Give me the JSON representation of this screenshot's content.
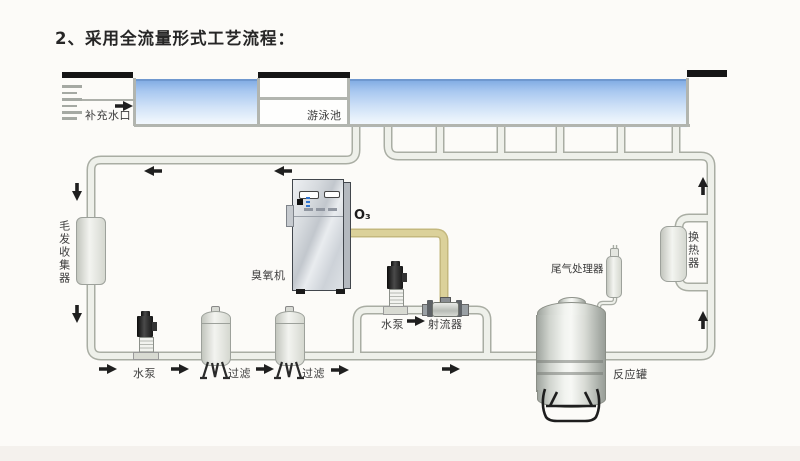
{
  "title": "2、采用全流量形式工艺流程：",
  "pool": {
    "makeup_inlet": "补充水口",
    "swimming_pool": "游泳池"
  },
  "equipment": {
    "hair_collector": "毛发收集器",
    "ozone_generator": "臭氧机",
    "ozone_gas": "O₃",
    "main_pump": "水泵",
    "filter_1": "过滤",
    "filter_2": "过滤",
    "booster_pump": "水泵",
    "jet_injector": "射流器",
    "tail_gas_processor": "尾气处理器",
    "reaction_tank": "反应罐",
    "heat_exchanger": "换热器"
  },
  "colors": {
    "pool_water_top": "#84aee4",
    "pipe_fill": "#eef0ea",
    "pipe_border": "#a9ada3",
    "ozone_pipe_fill": "#dbd19a",
    "ozone_pipe_border": "#c4b87e",
    "arrow": "#1f1f1f",
    "deck_bar": "#151515"
  },
  "flow_arrows": [
    {
      "dir": "right",
      "x": 124,
      "y": 106
    },
    {
      "dir": "left",
      "x": 153,
      "y": 171
    },
    {
      "dir": "left",
      "x": 283,
      "y": 171
    },
    {
      "dir": "down",
      "x": 77,
      "y": 192
    },
    {
      "dir": "down",
      "x": 77,
      "y": 314
    },
    {
      "dir": "right",
      "x": 108,
      "y": 369
    },
    {
      "dir": "right",
      "x": 180,
      "y": 369
    },
    {
      "dir": "right",
      "x": 265,
      "y": 369
    },
    {
      "dir": "right",
      "x": 340,
      "y": 370
    },
    {
      "dir": "right",
      "x": 451,
      "y": 369
    },
    {
      "dir": "right",
      "x": 416,
      "y": 321
    },
    {
      "dir": "up",
      "x": 703,
      "y": 186
    },
    {
      "dir": "up",
      "x": 703,
      "y": 320
    }
  ]
}
